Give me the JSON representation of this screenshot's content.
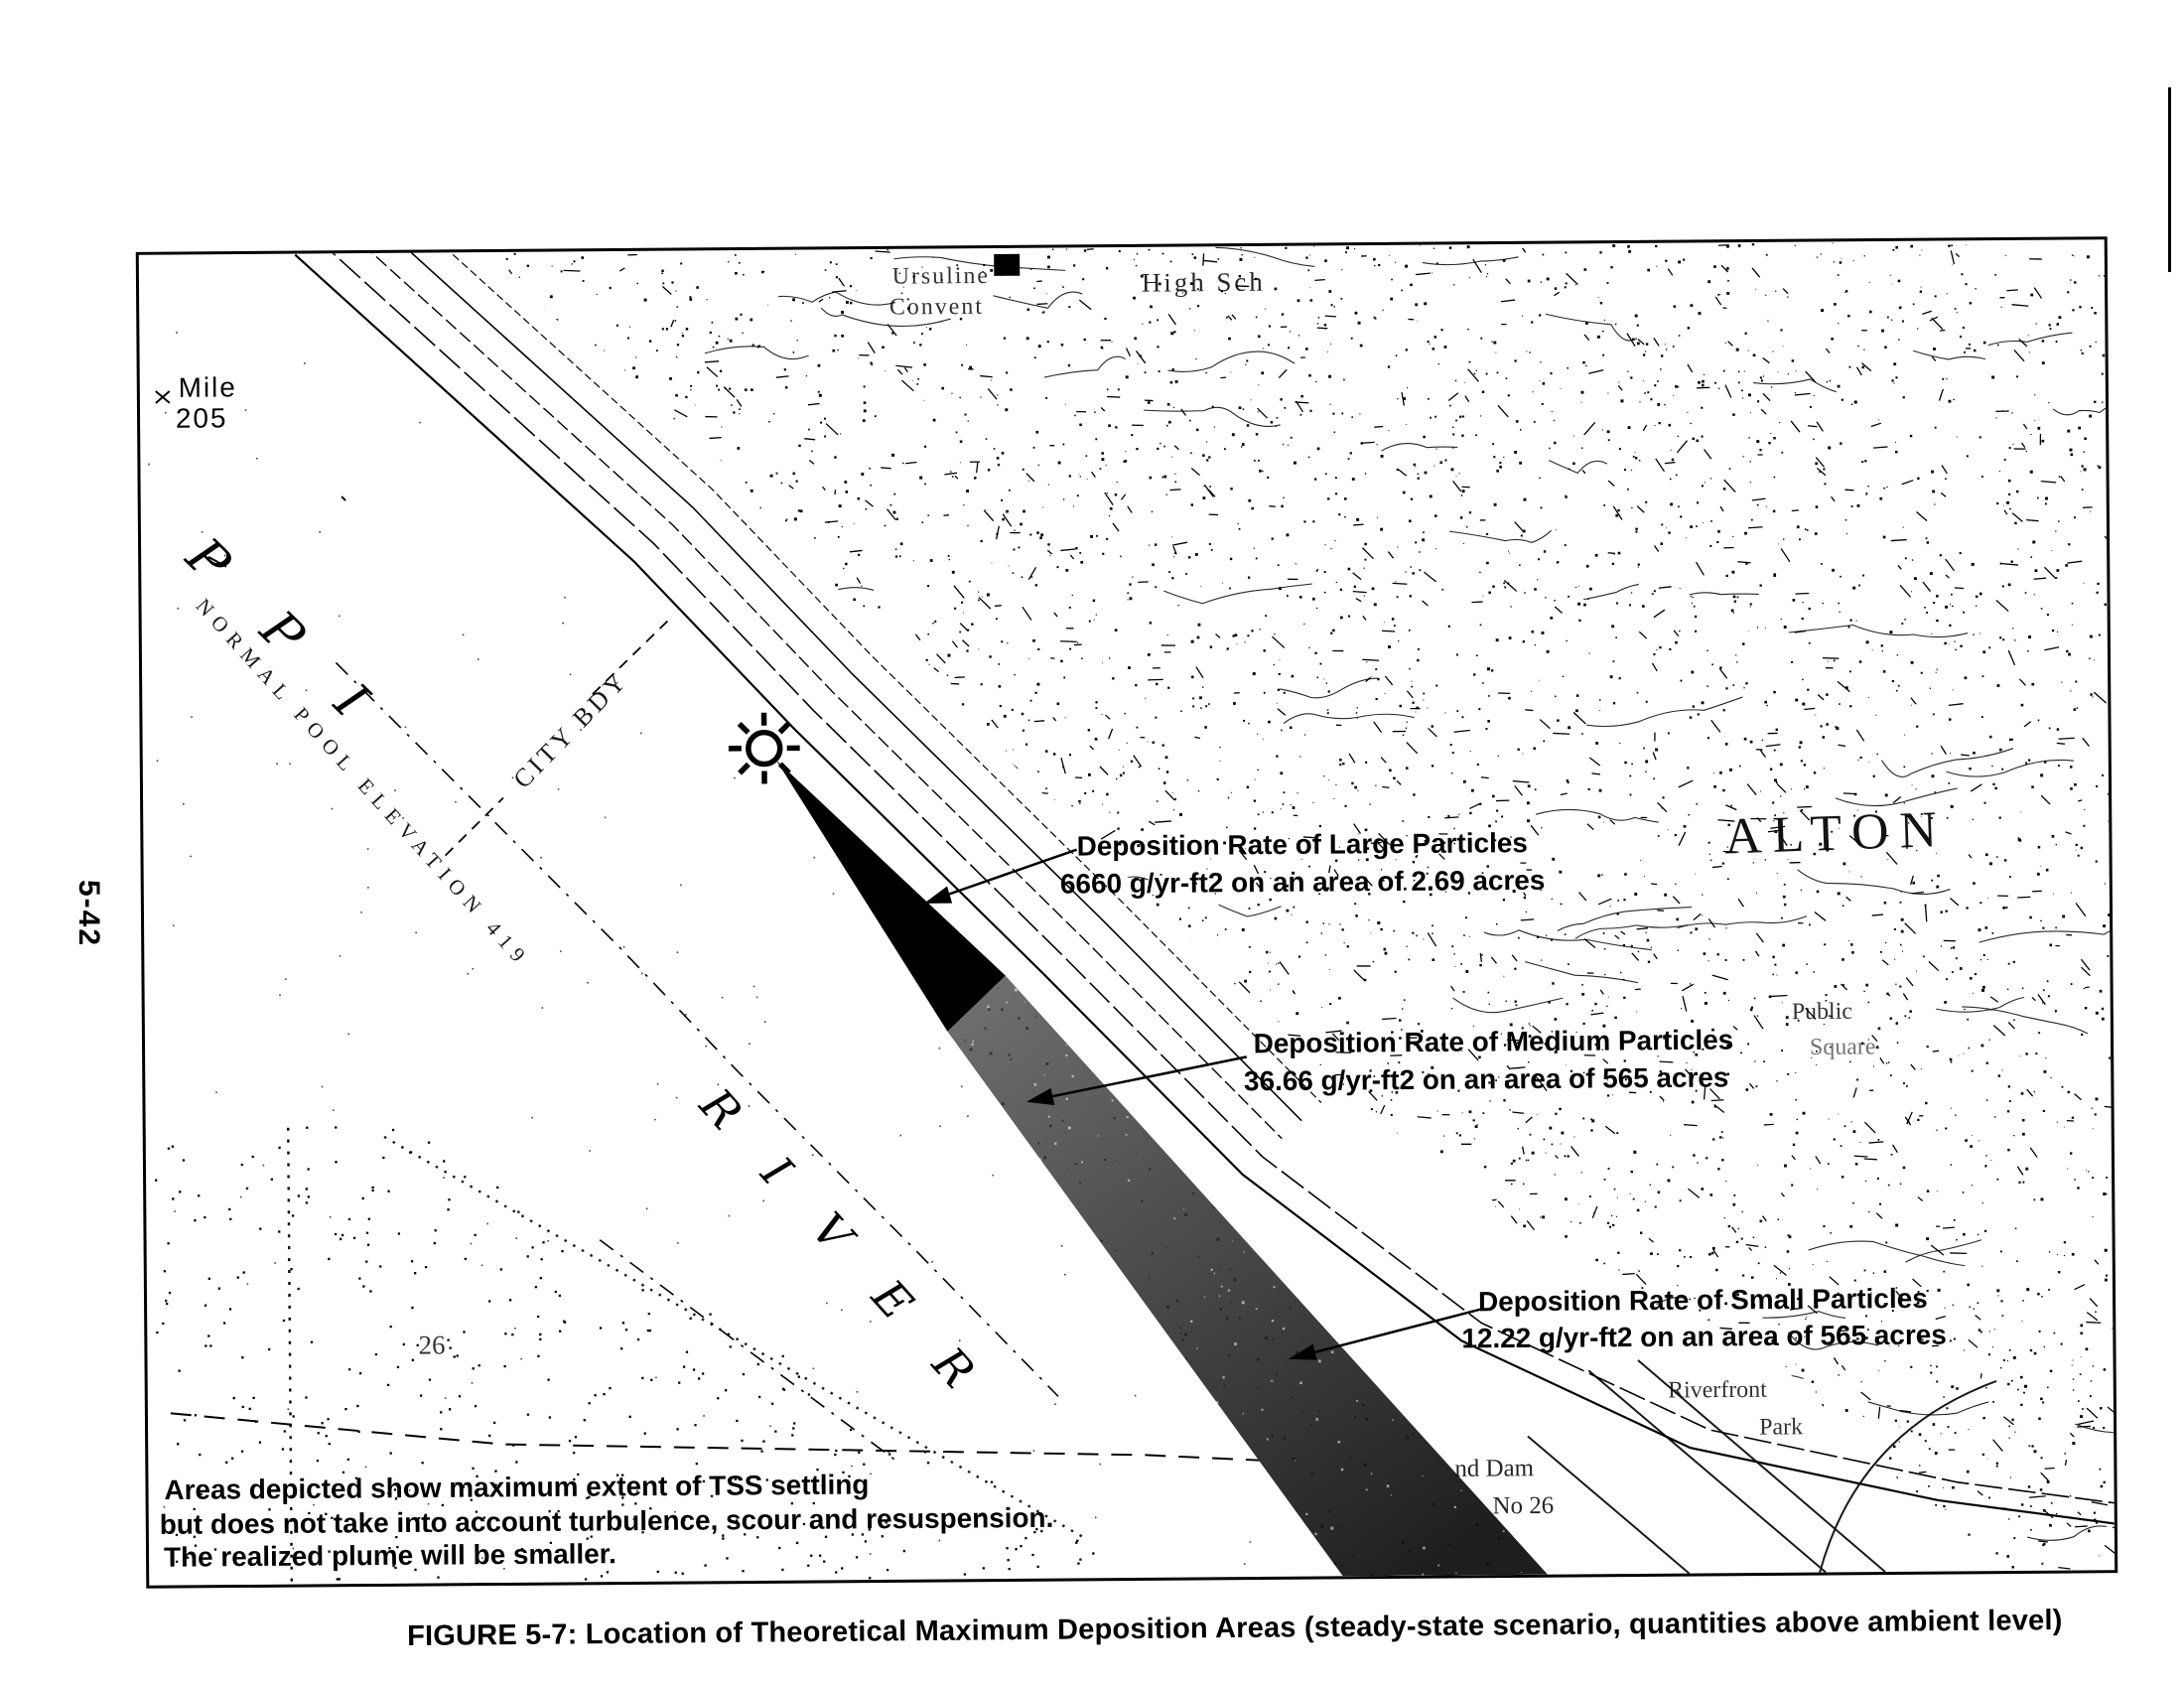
{
  "figure": {
    "side_page_number": "5-42",
    "caption": "FIGURE 5-7: Location of Theoretical Maximum Deposition Areas (steady-state scenario, quantities above ambient level)"
  },
  "annotations": {
    "large": {
      "line1": "Deposition Rate of Large Particles",
      "line2": "6660 g/yr-ft2 on an area of 2.69 acres"
    },
    "medium": {
      "line1": "Deposition Rate of Medium Particles",
      "line2": "36.66 g/yr-ft2 on an area of 565 acres"
    },
    "small": {
      "line1": "Deposition Rate of Small Particles",
      "line2": "12.22 g/yr-ft2 on an area of 565 acres"
    }
  },
  "note": {
    "line1": "Areas depicted show maximum extent of TSS settling",
    "line2": "but does not take into account turbulence, scour and resuspension.",
    "line3": "The realized plume will be smaller."
  },
  "map_labels": {
    "mile_line1": "Mile",
    "mile_line2": "205",
    "river_upper_letters": "PPI",
    "river_lower_letters": "RIVER",
    "pool_elevation": "NORMAL POOL ELEVATION 419",
    "city_boundary": "CITY BDY",
    "convent_line1": "Ursuline",
    "convent_line2": "Convent",
    "high_school": "High Sch",
    "city_name": "ALTON",
    "public_line1": "Public",
    "public_line2": "Square",
    "riverfront_line1": "Riverfront",
    "riverfront_line2": "Park",
    "dam_line1": "nd Dam",
    "dam_line2": "No 26",
    "island_number": "26"
  },
  "colors": {
    "ink": "#000000",
    "paper": "#ffffff",
    "plume_black": "#000000",
    "plume_gray_top": "#6e6e6e",
    "plume_gray_bottom": "#1e1e1e"
  }
}
